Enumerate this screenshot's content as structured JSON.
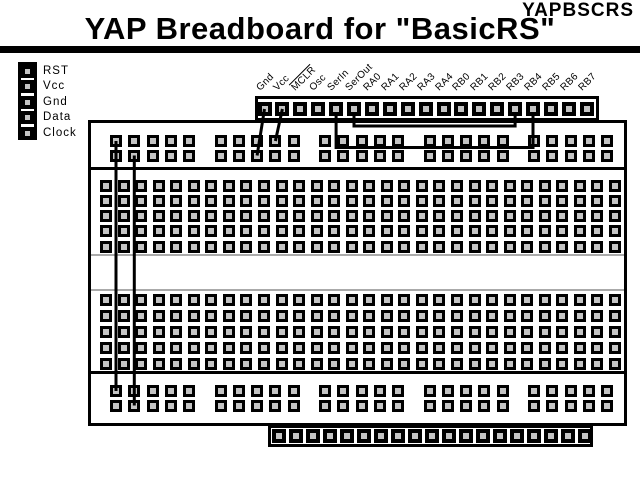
{
  "header": {
    "project_code": "YAPBSCRS",
    "title": "YAP Breadboard for \"BasicRS\""
  },
  "left_connector": {
    "pins": [
      "RST",
      "Vcc",
      "Gnd",
      "Data",
      "Clock"
    ]
  },
  "top_header": {
    "pins": [
      "Gnd",
      "Vcc",
      "MCLR",
      "Osc",
      "SerIn",
      "SerOut",
      "RA0",
      "RA1",
      "RA2",
      "RA3",
      "RA4",
      "RB0",
      "RB1",
      "RB2",
      "RB3",
      "RB4",
      "RB5",
      "RB6",
      "RB7"
    ],
    "overline_pin": "MCLR"
  },
  "bottom_header": {
    "pins": [
      "LED0",
      "LED1",
      "LED2",
      "LED3",
      "LED4",
      "LED5",
      "LED6",
      "LED7",
      "LED8",
      "LED9",
      "BUT1",
      "BUT2",
      "POT1",
      "POT2",
      "POT2-1",
      "POT2-2",
      "SPKR",
      "PU1",
      "PU2"
    ]
  },
  "breadboard": {
    "rail_groups": 5,
    "holes_per_group": 5,
    "rail_rows": 2,
    "main_columns": 30,
    "main_rows_per_half": 5
  },
  "wires": [
    {
      "name": "jumper-gnd-to-top-rail",
      "from": "top-pin:Gnd",
      "to": "top-rail:r2:g2:h3",
      "route": "direct"
    },
    {
      "name": "jumper-vcc-to-top-rail",
      "from": "top-pin:Vcc",
      "to": "top-rail:r1:g2:h4",
      "route": "direct"
    },
    {
      "name": "jumper-serin-to-rb4",
      "from": "top-pin:SerIn",
      "to": "top-pin:RB4",
      "route": "u-loop",
      "dip_y": 147.5
    },
    {
      "name": "jumper-serout-to-rb3",
      "from": "top-pin:SerOut",
      "to": "top-pin:RB3",
      "route": "u-loop",
      "dip_y": 126
    },
    {
      "name": "jumper-rail-left-1",
      "from": "top-rail:r1:g1:h1",
      "to": "bottom-rail:r1:g1:h1",
      "route": "direct"
    },
    {
      "name": "jumper-rail-left-2",
      "from": "top-rail:r2:g1:h2",
      "to": "bottom-rail:r2:g1:h2",
      "route": "direct"
    }
  ],
  "colors": {
    "line": "#000000",
    "hole_fill": "#c4c4c4",
    "background": "#ffffff",
    "channel_line": "#aaaaaa"
  }
}
